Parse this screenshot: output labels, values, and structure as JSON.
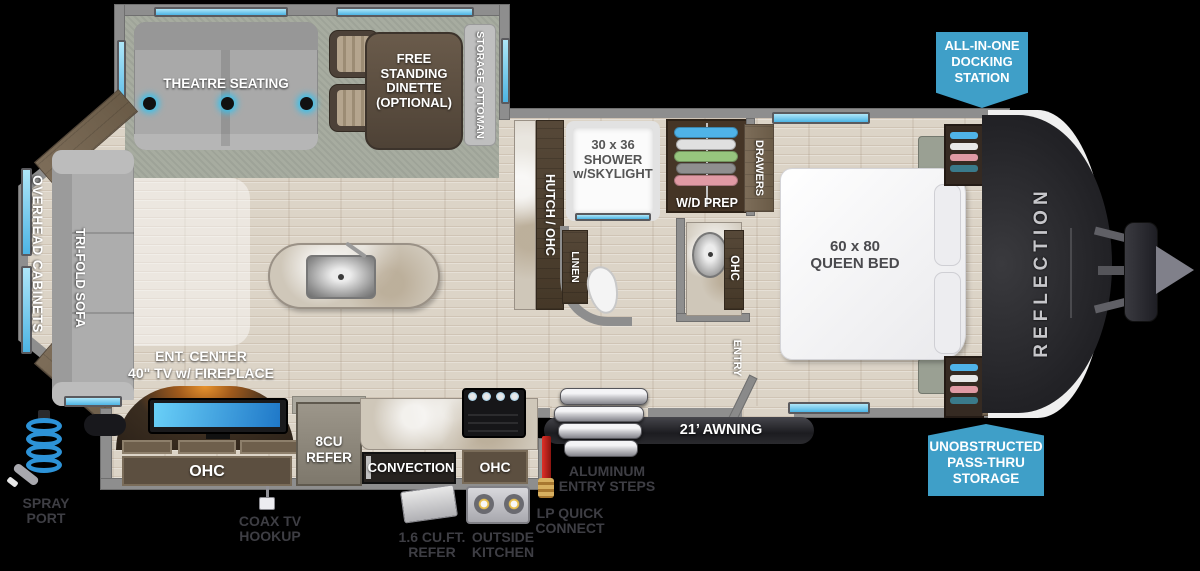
{
  "colors": {
    "callout_blue": "#3f9fc8",
    "window_blue": "#5ec4ea",
    "label_dark": "#3e3e44",
    "accent_glow": "#35c3f0"
  },
  "slide_top": {
    "theatre_label": "THEATRE SEATING",
    "dinette_label": [
      "FREE",
      "STANDING",
      "DINETTE",
      "(OPTIONAL)"
    ],
    "ottoman_label": "STORAGE OTTOMAN"
  },
  "living": {
    "overhead_cabinets_label": "OVERHEAD CABINETS",
    "sofa_label": "TRI-FOLD SOFA",
    "ent_center_label": [
      "ENT. CENTER",
      "40\" TV w/ FIREPLACE"
    ]
  },
  "bath": {
    "hutch_label": "HUTCH / OHC",
    "shower_label": [
      "30 x 36",
      "SHOWER",
      "w/SKYLIGHT"
    ],
    "wd_prep_label": "W/D PREP",
    "linen_label": "LINEN",
    "ohc_label": "OHC"
  },
  "bedroom": {
    "bed_label": [
      "60 x 80",
      "QUEEN BED"
    ],
    "drawers_label": "DRAWERS",
    "overhead_cabinets_label": "OVERHEAD CABINETS",
    "entry_label": "ENTRY",
    "brand": "REFLECTION"
  },
  "kitchen": {
    "ohc_left_label": "OHC",
    "refer_label": [
      "8CU",
      "REFER"
    ],
    "convection_label": "CONVECTION",
    "ohc_right_label": "OHC"
  },
  "exterior": {
    "awning_label": "21’ AWNING",
    "steps_label": [
      "ALUMINUM",
      "ENTRY STEPS"
    ],
    "lp_label": [
      "LP QUICK",
      "CONNECT"
    ],
    "outside_kitchen_label": [
      "OUTSIDE",
      "KITCHEN"
    ],
    "outside_refer_label": [
      "1.6 CU.FT.",
      "REFER"
    ],
    "coax_label": [
      "COAX TV",
      "HOOKUP"
    ],
    "spray_label": [
      "SPRAY",
      "PORT"
    ]
  },
  "callouts": {
    "docking": [
      "ALL-IN-ONE",
      "DOCKING",
      "STATION"
    ],
    "passthru": [
      "UNOBSTRUCTED",
      "PASS-THRU",
      "STORAGE"
    ]
  }
}
